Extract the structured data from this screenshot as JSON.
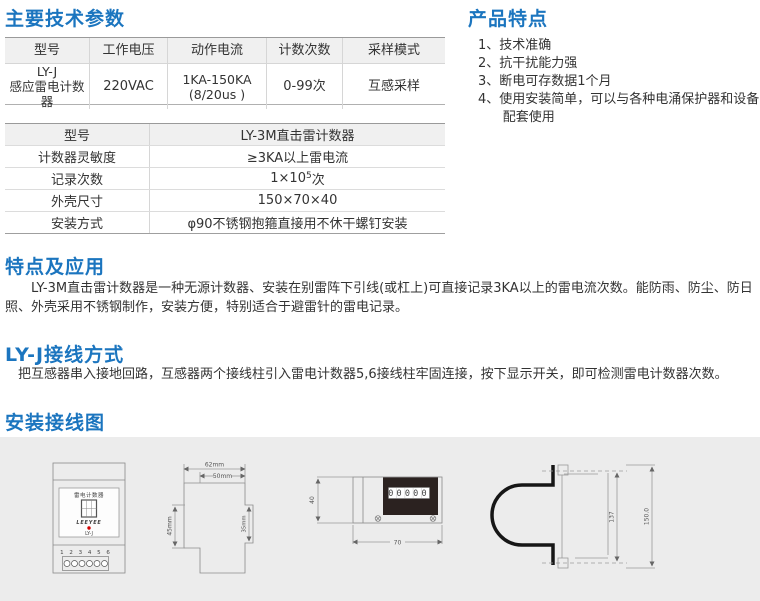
{
  "colors": {
    "heading_blue": "#1b75bf",
    "body_text": "#333333",
    "table_header_bg": "#f0f0f0",
    "table_border_dark": "#9a9a9a",
    "table_border_light": "#d6d6d6",
    "diagram_panel_bg": "#ececec",
    "counter_panel_black": "#2b2220",
    "indicator_red": "#d40000"
  },
  "sections": {
    "tech_params": {
      "title": "主要技术参数"
    },
    "product_features": {
      "title": "产品特点",
      "items": [
        "1、技术准确",
        "2、抗干扰能力强",
        "3、断电可存数据1个月",
        "4、使用安装简单，可以与各种电涌保护器和设备配套使用"
      ]
    },
    "features_app": {
      "title": "特点及应用",
      "body": "LY-3M直击雷计数器是一种无源计数器、安装在别雷阵下引线(或杠上)可直接记录3KA以上的雷电流次数。能防雨、防尘、防日照、外壳采用不锈钢制作，安装方便，特别适合于避雷针的雷电记录。"
    },
    "wiring": {
      "title": "LY-J接线方式",
      "body": "把互感器串入接地回路，互感器两个接线柱引入雷电计数器5,6接线柱牢固连接，按下显示开关，即可检测雷电计数器次数。"
    },
    "install": {
      "title": "安装接线图"
    }
  },
  "table1": {
    "headers": [
      "型号",
      "工作电压",
      "动作电流",
      "计数次数",
      "采样模式"
    ],
    "row": {
      "model_line1": "LY-J",
      "model_line2": "感应雷电计数器",
      "voltage": "220VAC",
      "current_line1": "1KA-150KA",
      "current_line2": "(8/20us )",
      "count": "0-99次",
      "sampling": "互感采样"
    }
  },
  "table2": {
    "header": {
      "label": "型号",
      "value": "LY-3M直击雷计数器"
    },
    "rows": [
      {
        "label": "计数器灵敏度",
        "value": "≥3KA以上雷电流"
      },
      {
        "label": "记录次数",
        "value_base": "1×10",
        "value_sup": "5",
        "value_tail": "次"
      },
      {
        "label": "外壳尺寸",
        "value": "150×70×40"
      },
      {
        "label": "安装方式",
        "value": "φ90不锈钢抱箍直接用不休干螺钉安装"
      }
    ]
  },
  "diagrams": {
    "front_view": {
      "device_label": "雷电计数器",
      "brand": "LEEYEE",
      "model": "LY-J",
      "terminal_numbers": "1 2 3 4 5 6"
    },
    "profile": {
      "dim_width_outer": "62mm",
      "dim_width_inner": "50mm",
      "dim_height_left": "45mm",
      "dim_height_right": "35mm"
    },
    "side_view": {
      "counter_display": "00000",
      "dim_height": "40",
      "dim_width": "70"
    },
    "clamp": {
      "dim_inner": "137",
      "dim_outer": "150.0"
    }
  }
}
